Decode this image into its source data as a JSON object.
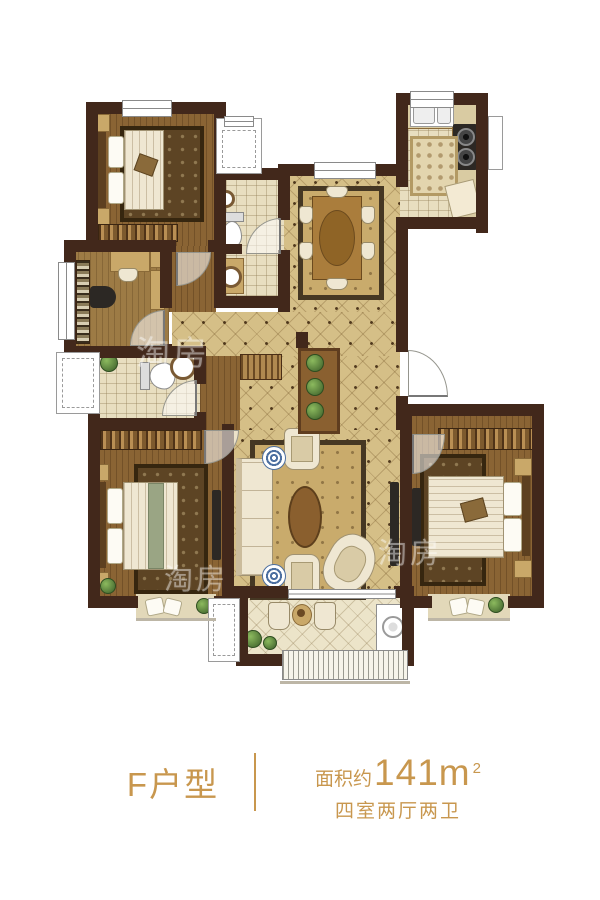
{
  "caption": {
    "unit_label": "F户型",
    "area_prefix": "面积约",
    "area_value": "141m",
    "area_sup": "2",
    "layout_text": "四室两厅两卫"
  },
  "watermark": {
    "text": "淘房"
  },
  "colors": {
    "accent": "#c8974e",
    "wall": "#42281b",
    "wood": "#8a6434",
    "wood2": "#9d7b45",
    "tile": "#d5bf87",
    "grid": "#e8dec0",
    "btile": "#ece4c9",
    "rug": "#5d4424",
    "linen": "#efe7d2",
    "blue": "#4c6fa0",
    "plant": "#4f7436"
  }
}
